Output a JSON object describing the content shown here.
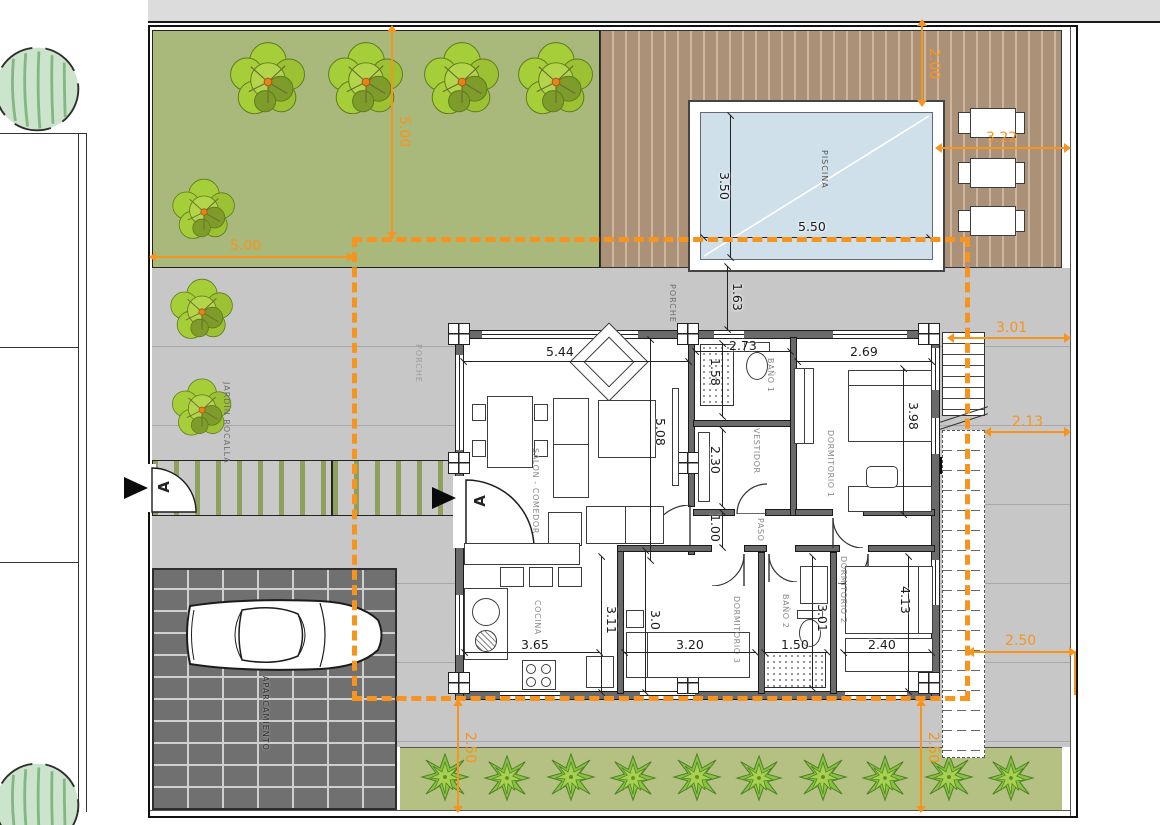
{
  "colors": {
    "accent": "#F7941E",
    "garden": "#A9B87B",
    "deck": "#AC9179",
    "pool_water": "#CFE0EB",
    "terrace": "#C7C7C7",
    "parking": "#707070",
    "hedge": "#B4C183"
  },
  "areas": {
    "piscina": "PISCINA",
    "porche_top": "PORCHE",
    "porche_left": "PORCHE",
    "jardin": "JARDÍN ROCALLA",
    "aparcamiento": "APARCAMIENTO"
  },
  "rooms": {
    "salon": "SALON - COMEDOR",
    "cocina": "COCINA",
    "bano1": "BAÑO 1",
    "vestidor": "VESTIDOR",
    "dorm1": "DORMITORIO 1",
    "paso": "PASO",
    "dorm3": "DORMITORIO 3",
    "bano2": "BAÑO 2",
    "dorm2": "DORMITORIO 2"
  },
  "dims": {
    "salon_w": "5.44",
    "salon_h": "5.08",
    "cocina_w": "3.65",
    "cocina_h": "3.11",
    "bano1_w": "2.73",
    "bano1_h": "1.58",
    "vestidor_h": "2.30",
    "paso_h": "1.00",
    "dorm1_w": "2.69",
    "dorm1_h": "3.98",
    "dorm3_w": "3.20",
    "dorm3_h": "3.0",
    "bano2_w": "1.50",
    "bano2_h": "3.01",
    "dorm2_w": "2.40",
    "dorm2_h": "4.13",
    "pool_w": "5.50",
    "pool_h": "3.50",
    "porch_gap": "1.63",
    "setback_top": "5.00",
    "setback_left": "5.00",
    "pool_offset": "2.00",
    "deck_side": "3.22",
    "stair_side": "3.01",
    "stair_side2": "2.13",
    "side_right": "2.50",
    "bottom_left": "2.50",
    "bottom_right": "2.50"
  },
  "markers": {
    "entrance": "A",
    "gate": "A"
  }
}
